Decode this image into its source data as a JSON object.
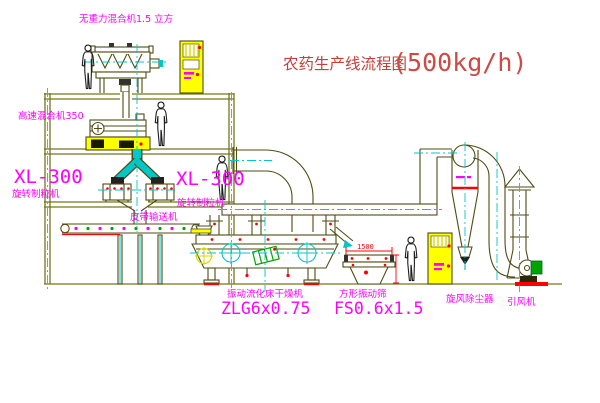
{
  "title": {
    "text": "农药生产线流程图",
    "capacity": "(500kg/h)"
  },
  "equipment": {
    "gravity_mixer": {
      "label": "无重力混合机1.5 立方"
    },
    "high_speed_mixer": {
      "label": "高速混合机350"
    },
    "granulator_left": {
      "model": "XL-300",
      "name": "旋转制粒机"
    },
    "granulator_right": {
      "model": "XL-300",
      "name": "旋转制粒机"
    },
    "belt_conveyor": {
      "label": "皮带输送机"
    },
    "dryer": {
      "name": "振动流化床干燥机",
      "model": "ZLG6x0.75"
    },
    "sieve": {
      "name": "方形振动筛",
      "model": "FS0.6x1.5",
      "dimension": "1500"
    },
    "cyclone": {
      "label": "旋风除尘器"
    },
    "fan": {
      "label": "引风机"
    }
  },
  "colors": {
    "label_magenta": "#FF00FF",
    "title_red": "#C4403B",
    "line_olive": "#76761e",
    "machine_olive": "#4d4d15",
    "centerline_cyan": "#00C8C8",
    "cabinet_yellow": "#FFFF00",
    "accent_red": "#FF0000",
    "motor_green": "#00A300"
  }
}
